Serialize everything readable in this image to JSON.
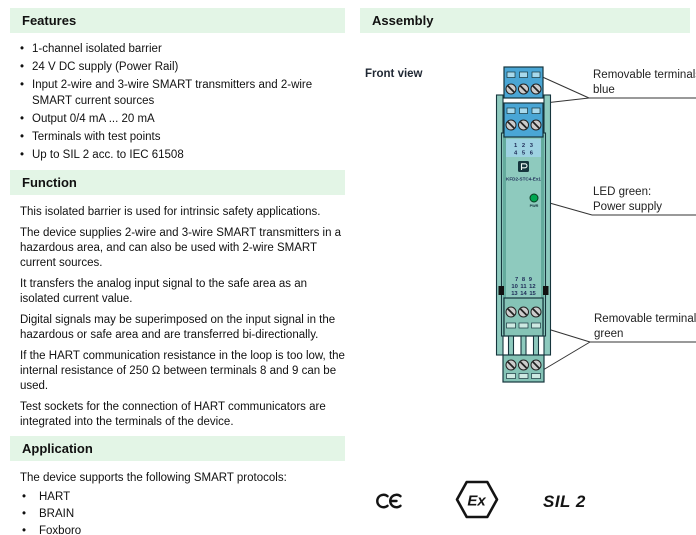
{
  "colors": {
    "section-bg": "#e3f5e6",
    "text": "#111111",
    "device-body": "#8ecabe",
    "device-body-edge": "#64ab9d",
    "device-outline": "#16353d",
    "terminal-blue": "#4aa6d5",
    "terminal-blue-light": "#a8d9ec",
    "numbers-strip": "#9ed2e2",
    "terminal-green": "#85c3b6",
    "green-light": "#cde9e2",
    "led-green": "#00a651",
    "screw": "#cccccc",
    "label-ink": "#1d2a56",
    "line": "#333333"
  },
  "left": {
    "features": {
      "title": "Features",
      "items": [
        "1-channel isolated barrier",
        "24 V DC supply (Power Rail)",
        "Input 2-wire and 3-wire SMART transmitters and 2-wire SMART current sources",
        "Output 0/4 mA ... 20 mA",
        "Terminals with test points",
        "Up to SIL 2 acc. to IEC 61508"
      ]
    },
    "function": {
      "title": "Function",
      "paragraphs": [
        "This isolated barrier is used for intrinsic safety applications.",
        "The device supplies 2-wire and 3-wire SMART transmitters in a hazardous area, and can also be used with 2-wire SMART current sources.",
        "It transfers the analog input signal to the safe area as an isolated current value.",
        "Digital signals may be superimposed on the input signal in the hazardous or safe area and are transferred bi-directionally.",
        "If the HART communication resistance in the loop is too low, the internal resistance of 250 Ω between terminals 8 and 9 can be used.",
        "Test sockets for the connection of HART communicators are integrated into the terminals of the device."
      ]
    },
    "application": {
      "title": "Application",
      "intro": "The device supports the following SMART protocols:",
      "items": [
        "HART",
        "BRAIN",
        "Foxboro"
      ]
    }
  },
  "right": {
    "assembly_title": "Assembly",
    "front_view_label": "Front view",
    "device": {
      "model": "KFD2-STC4-Ex1",
      "brand_logo_icon": "pepperl-fuchs-logo",
      "led_label": "PWR",
      "terminal_numbers_top_row1": "1 2 3",
      "terminal_numbers_top_row2": "4 5 6",
      "terminal_numbers_bottom_row1": "7 8 9",
      "terminal_numbers_bottom_row2": "10 11 12",
      "terminal_numbers_bottom_row3": "13 14 15"
    },
    "callouts": {
      "blue_terminals": "Removable terminals\nblue",
      "led": "LED green:\nPower supply",
      "green_terminals": "Removable terminals\ngreen"
    },
    "certifications": {
      "ce": "CE",
      "ex": "Ex",
      "sil": "SIL 2"
    }
  }
}
